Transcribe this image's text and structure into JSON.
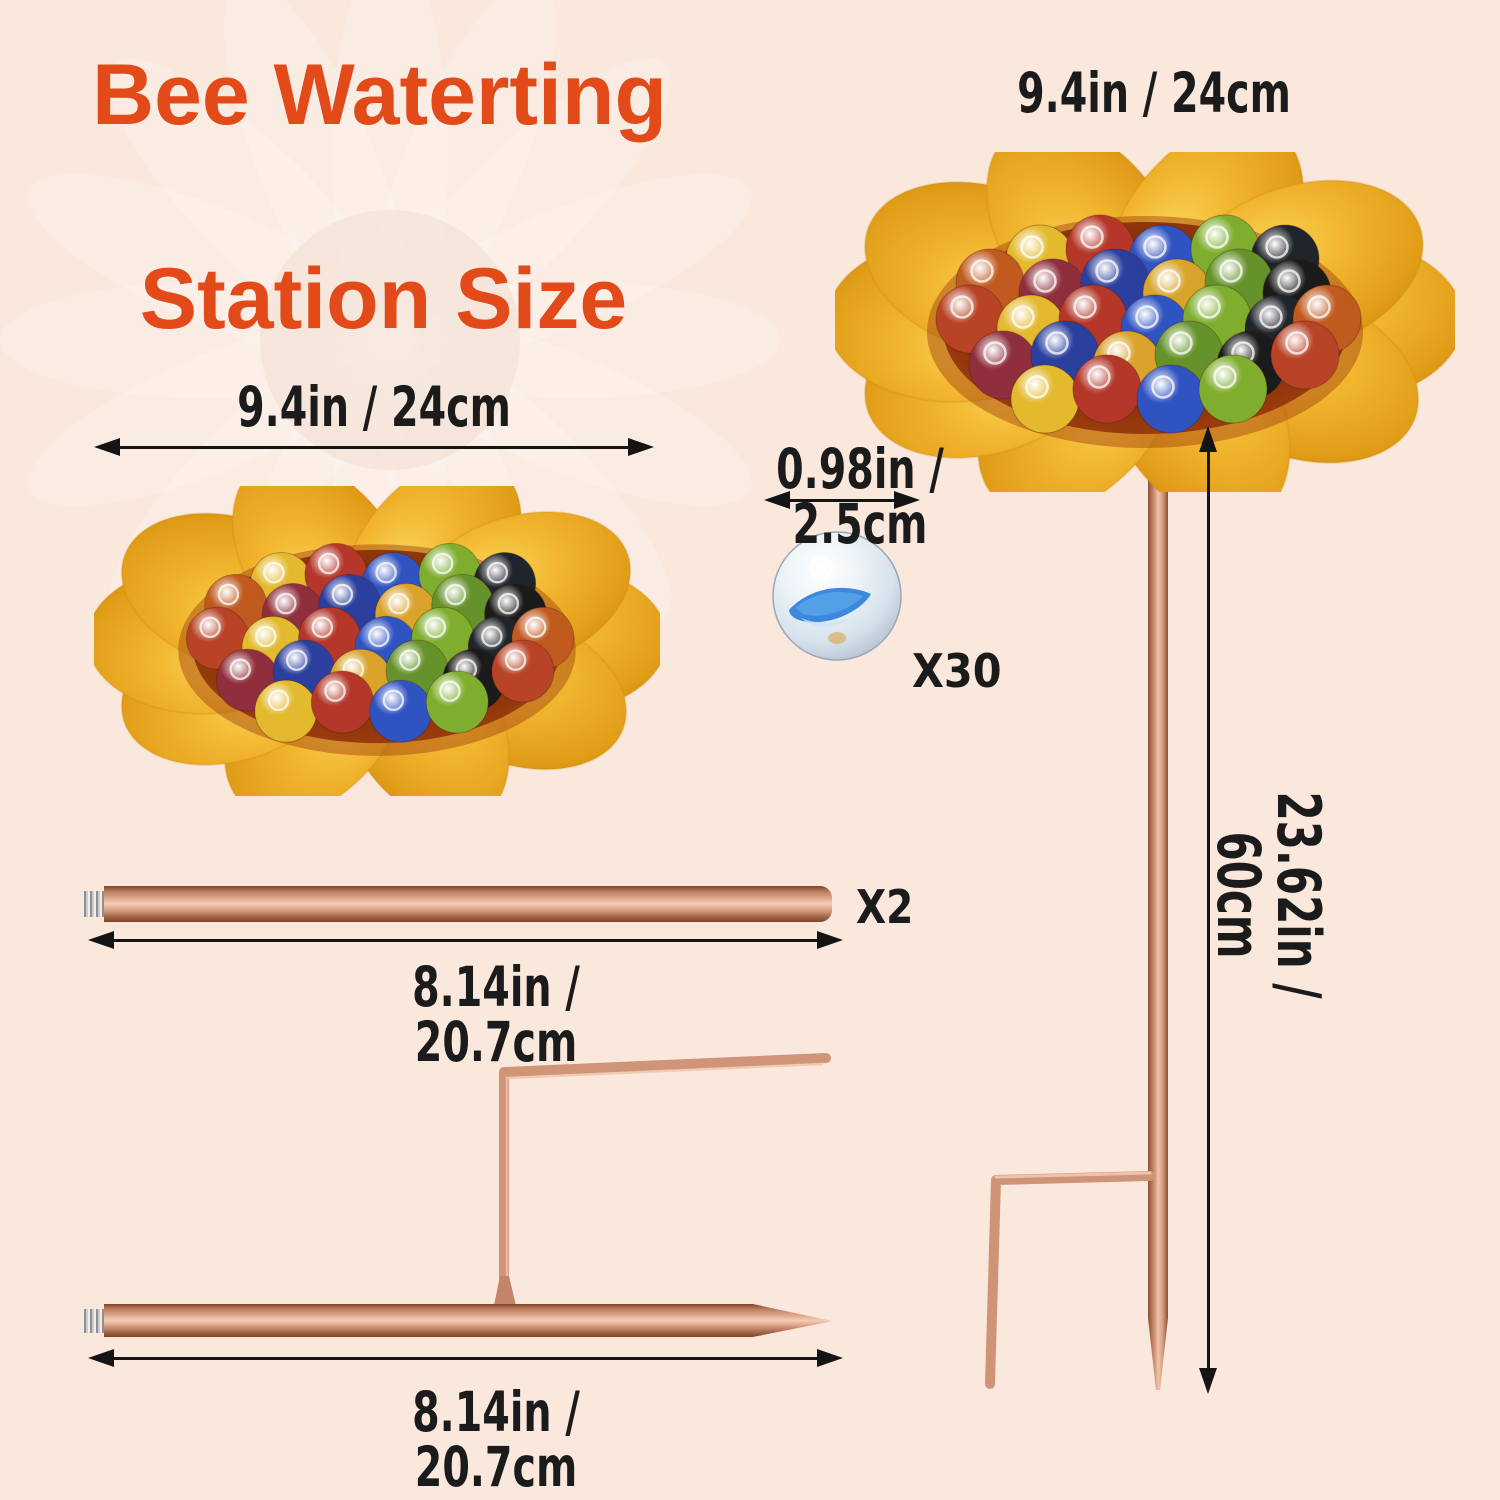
{
  "title": {
    "line1": "Bee Waterting",
    "line2": "Station Size"
  },
  "dimensions": {
    "top_dish_width": "9.4in / 24cm",
    "left_dish_width": "9.4in / 24cm",
    "marble_diameter": "0.98in / 2.5cm",
    "pole_length": "8.14in / 20.7cm",
    "stake_length": "8.14in / 20.7cm",
    "station_height": "23.62in / 60cm"
  },
  "counts": {
    "marbles": "X30",
    "poles": "X2"
  },
  "colors": {
    "background": "#fae8dc",
    "title": "#e24a1a",
    "text": "#1b1b1b",
    "arrow": "#141414",
    "copper": "#d79a7c",
    "gold_dish": "#f0b42e",
    "bowl_amber": "#7c2a08"
  },
  "marble_colors": [
    "#e3b92d",
    "#b5372a",
    "#3053c2",
    "#7fae2f",
    "#20242b",
    "#c05a1f",
    "#8f2e3c",
    "#2b3f9e",
    "#d9a32c",
    "#65922a",
    "#1b1b1b",
    "#b84326"
  ]
}
